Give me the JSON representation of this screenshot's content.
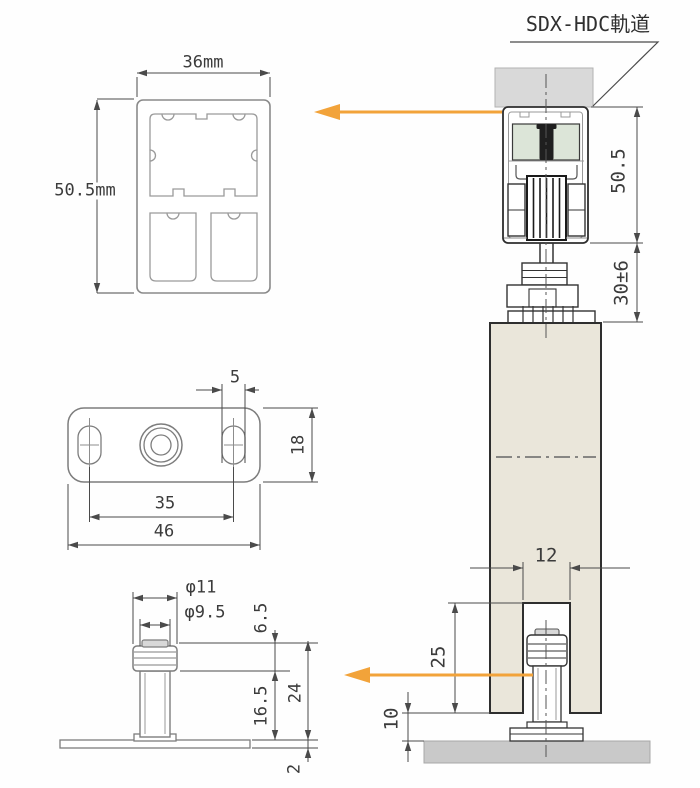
{
  "title": "SDX-HDC軌道",
  "colors": {
    "arrow": "#F2A33A",
    "door_fill": "#EAE6DA",
    "roller_fill": "#DCE5D8",
    "ceiling_fill": "#D9D9D9",
    "floor_fill": "#C9C9C9",
    "outline": "#2E2E2E",
    "dim_line": "#4A4A4A"
  },
  "rail_section": {
    "width": "36mm",
    "height": "50.5mm"
  },
  "mount_plate": {
    "slot_width": "5",
    "height": "18",
    "hole_spacing": "35",
    "width": "46"
  },
  "floor_guide": {
    "cap_diameter": "φ11",
    "stem_diameter": "φ9.5",
    "cap_height": "6.5",
    "stem_height": "16.5",
    "total_height": "24",
    "plate_thickness": "2"
  },
  "assembly": {
    "rail_height": "50.5",
    "hanger_range": "30±6",
    "groove_width": "12",
    "groove_depth": "25",
    "floor_clearance": "10"
  }
}
